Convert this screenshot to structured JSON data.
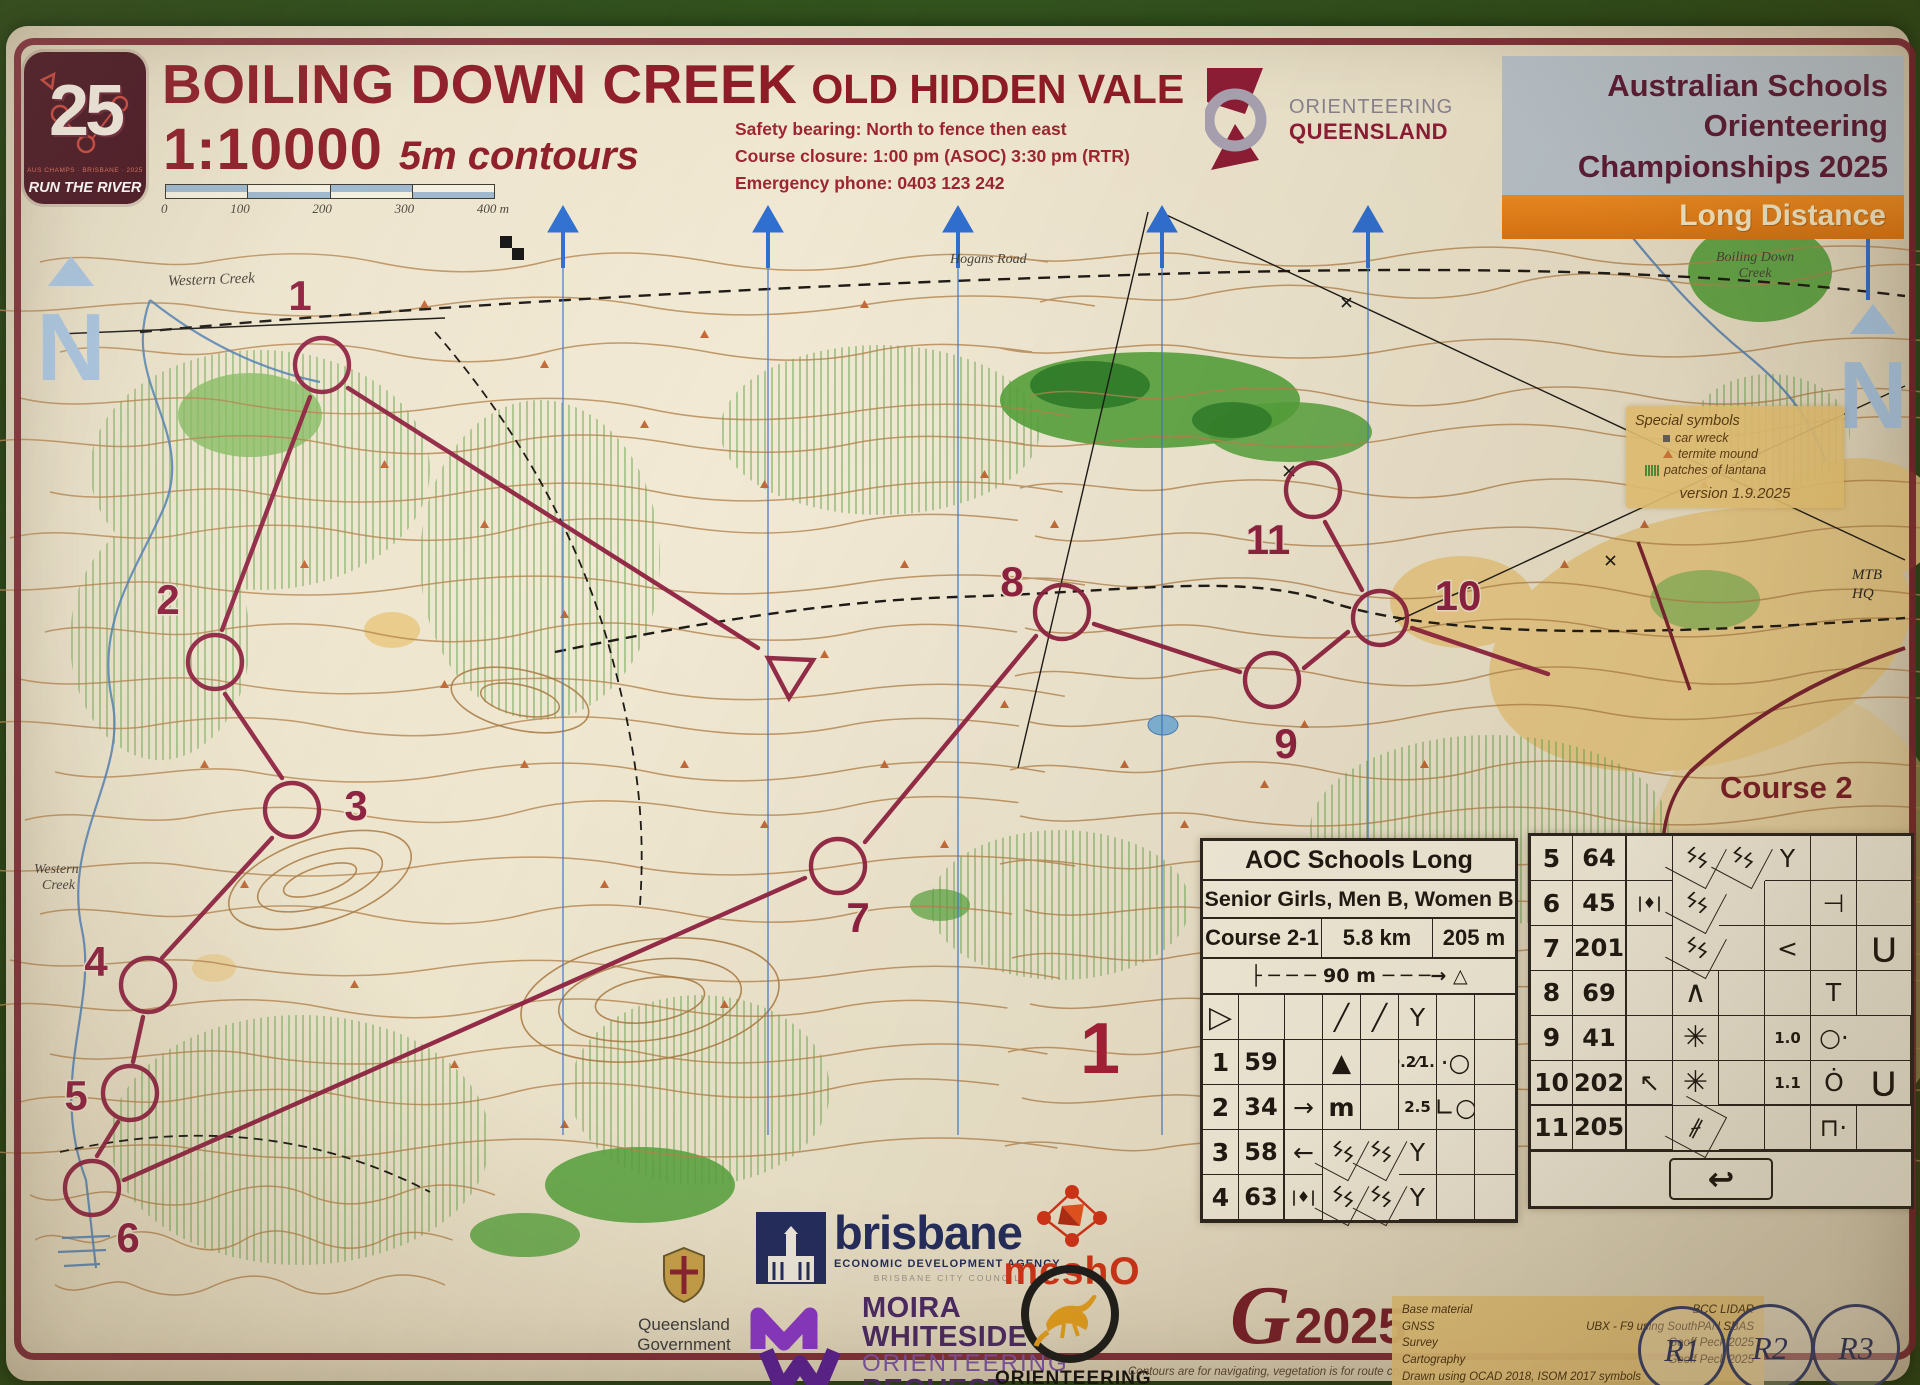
{
  "header": {
    "logo25": {
      "number": "25",
      "subtext": "AUS CHAMPS · BRISBANE · 2025",
      "label": "RUN THE RIVER"
    },
    "title": "BOILING DOWN CREEK",
    "subtitle": "OLD HIDDEN VALE",
    "scale": "1:10000",
    "contours": "5m contours",
    "scalebar_ticks": [
      "0",
      "100",
      "200",
      "300",
      "400 m"
    ],
    "safety_line1": "Safety bearing: North to fence then east",
    "safety_line2": "Course closure: 1:00 pm (ASOC) 3:30 pm (RTR)",
    "safety_line3": "Emergency phone: 0403 123 242",
    "oq": {
      "line1": "ORIENTEERING",
      "line2": "QUEENSLAND"
    },
    "champ": {
      "line1": "Australian Schools",
      "line2": "Orienteering",
      "line3": "Championships 2025",
      "banner": "Long Distance"
    }
  },
  "map": {
    "labels": {
      "western_creek_top": "Western Creek",
      "hogans_road": "Hogans Road",
      "boiling_down_1": "Boiling Down",
      "boiling_down_2": "Creek",
      "western_1": "Western",
      "western_2": "Creek",
      "mtb_1": "MTB",
      "mtb_2": "HQ",
      "course_label": "Course 2",
      "map_number": "1"
    },
    "special_symbols": {
      "title": "Special symbols",
      "item1": "car wreck",
      "item2": "termite mound",
      "item3": "patches of lantana",
      "version": "version 1.9.2025"
    },
    "controls": [
      "1",
      "2",
      "3",
      "4",
      "5",
      "6",
      "7",
      "8",
      "9",
      "10",
      "11"
    ]
  },
  "desc": {
    "title": "AOC Schools Long",
    "classes": "Senior Girls, Men B, Women B",
    "course": "Course 2-1",
    "length": "5.8 km",
    "climb": "205 m",
    "taped_pre": "├ ─ ─ ─",
    "taped": "90 m",
    "taped_post": "─ ─ ─→ △",
    "start_symbol": "▷",
    "srow": {
      "d": "╱",
      "e": "╱",
      "f": "Y"
    },
    "rows": [
      {
        "n": "1",
        "code": "59",
        "c": "",
        "d": "▲",
        "e": "",
        "f": "0.2⁄1.2",
        "g": "·○",
        "h": ""
      },
      {
        "n": "2",
        "code": "34",
        "c": "→",
        "d": "m",
        "e": "",
        "f": "2.5",
        "g": "∟○",
        "h": ""
      },
      {
        "n": "3",
        "code": "58",
        "c": "←",
        "d": "ϟϟ",
        "e": "ϟϟ",
        "f": "Y",
        "g": "",
        "h": ""
      },
      {
        "n": "4",
        "code": "63",
        "c": "|♦|",
        "d": "ϟϟ",
        "e": "ϟϟ",
        "f": "Y",
        "g": "",
        "h": ""
      },
      {
        "n": "5",
        "code": "64",
        "c": "",
        "d": "ϟϟ",
        "e": "ϟϟ",
        "f": "Y",
        "g": "",
        "h": ""
      },
      {
        "n": "6",
        "code": "45",
        "c": "|♦|",
        "d": "ϟϟ",
        "e": "",
        "f": "",
        "g": "⊣",
        "h": ""
      },
      {
        "n": "7",
        "code": "201",
        "c": "",
        "d": "ϟϟ",
        "e": "",
        "f": "<",
        "g": "",
        "h": "⋃"
      },
      {
        "n": "8",
        "code": "69",
        "c": "",
        "d": "∧",
        "e": "",
        "f": "",
        "g": "T",
        "h": ""
      },
      {
        "n": "9",
        "code": "41",
        "c": "",
        "d": "✳",
        "e": "",
        "f": "1.0",
        "g": "○·",
        "h": ""
      },
      {
        "n": "10",
        "code": "202",
        "c": "↖",
        "d": "✳",
        "e": "",
        "f": "1.1",
        "g": "Ȯ",
        "h": "⋃"
      },
      {
        "n": "11",
        "code": "205",
        "c": "",
        "d": "∦",
        "e": "",
        "f": "",
        "g": "⊓·",
        "h": ""
      }
    ],
    "finish_symbol": "↩"
  },
  "footer": {
    "qld": {
      "line1": "Queensland",
      "line2": "Government"
    },
    "brisbane": {
      "name": "brisbane",
      "tagline": "ECONOMIC DEVELOPMENT AGENCY",
      "sub": "BRISBANE CITY COUNCIL"
    },
    "mesho": "meshO",
    "mw": {
      "line1": "MOIRA",
      "line2": "WHITESIDE",
      "line3": "ORIENTEERING",
      "line4": "BEQUEST"
    },
    "oa": {
      "line1": "ORIENTEERING",
      "line2": "AUSTRALIA"
    },
    "g2025": {
      "g": "G",
      "year": "2025"
    },
    "note": "Contours are for navigating, vegetation is for route choice",
    "credits": {
      "row1": {
        "label": "Base material",
        "value": "BCC LIDAR"
      },
      "row2": {
        "label": "GNSS",
        "value": "UBX - F9 using SouthPAN SBAS"
      },
      "row3": {
        "label": "Survey",
        "value": "Geoff Peck 2025"
      },
      "row4": {
        "label": "Cartography",
        "value": "Geoff Peck 2025"
      },
      "last": "Drawn using OCAD 2018,  ISOM 2017 symbols"
    },
    "relay": [
      "R1",
      "R2",
      "R3"
    ]
  }
}
